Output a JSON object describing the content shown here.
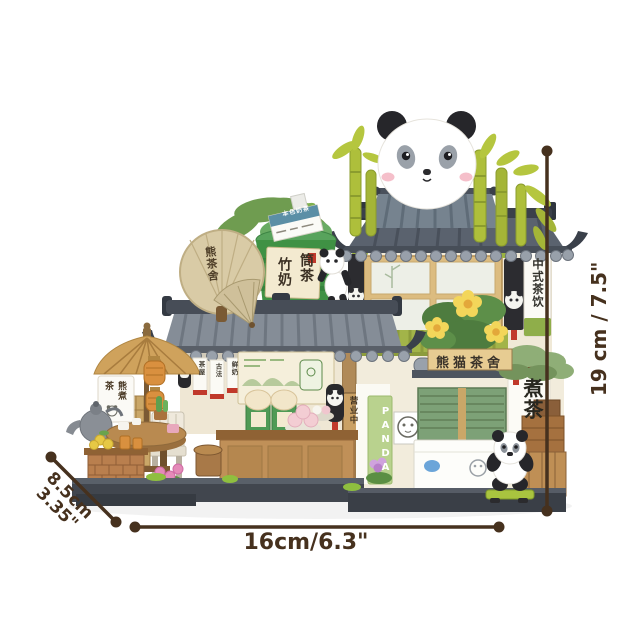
{
  "meta": {
    "description": "Product photo of a panda tea house brick building set with dimension annotations",
    "background_color": "#ffffff"
  },
  "dimensions": {
    "height": "19 cm / 7.5\"",
    "width": "16cm/6.3\"",
    "depth_cm": "8.5cm",
    "depth_in": "3.35\"",
    "line_color": "#46311e"
  },
  "signs": {
    "fan": "熊茶舍",
    "hanging_board": "本色奶茶",
    "bamboo_cup_col_right": "筒茶",
    "bamboo_cup_col_left": "竹奶",
    "tea_style": "中式茶饮",
    "shop_plaque": "熊猫茶舍",
    "panda_banner": "PANDA",
    "boil_tea": "煮茶",
    "open_board": "营业中",
    "stand_sign": "熊煮茶",
    "eave_banners": [
      "茶屋",
      "古法",
      "鲜奶"
    ]
  },
  "palette": {
    "bamboo_green": "#b2c53e",
    "cup_green": "#3f9144",
    "awning_green": "#a2b449",
    "shutter_green": "#7da177",
    "banner_green": "#b9d28e",
    "roof_dark": "#474d57",
    "roof_tile": "#99a1ab",
    "wall_cream": "#efe8d6",
    "wood_tan": "#c09058",
    "lantern_orange": "#d9903f",
    "seal_red": "#c0392b",
    "blush_pink": "#f5bfca",
    "panda_black": "#26262a",
    "dimension_brown": "#46311e"
  }
}
